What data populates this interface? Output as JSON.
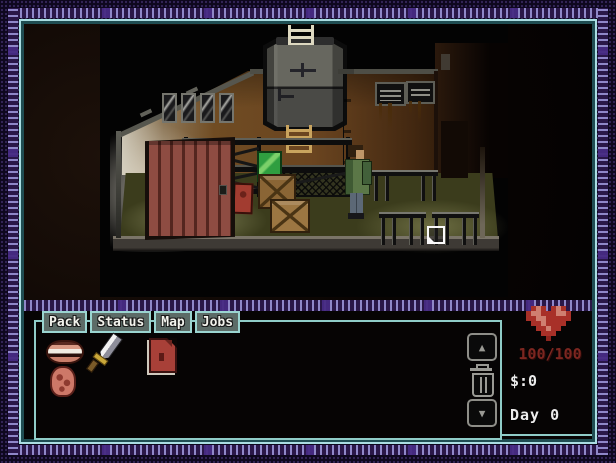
{
  "tabs": [
    {
      "label": "Pack"
    },
    {
      "label": "Status"
    },
    {
      "label": "Map"
    },
    {
      "label": "Jobs"
    }
  ],
  "inventory": {
    "items": [
      {
        "name": "dentures"
      },
      {
        "name": "machete"
      },
      {
        "name": "red-book"
      },
      {
        "name": "raw-meat"
      }
    ],
    "controls": {
      "up": "arrow-up-icon",
      "trash": "trash-icon",
      "down": "arrow-down-icon"
    },
    "up_glyph": "▲",
    "down_glyph": "▼"
  },
  "stats": {
    "health": "100/100",
    "money": "$:0",
    "day": "Day 0"
  },
  "scene": {
    "objects": [
      "water-tank",
      "roof-ladder",
      "floor-ladder",
      "barred-window",
      "wall-vents",
      "plank-door",
      "storage-rack",
      "mesh-counter",
      "green-box",
      "wooden-crates",
      "red-canister",
      "survivor-character",
      "work-benches",
      "page-cursor"
    ]
  },
  "colors": {
    "frame_dash": "#8f87c8",
    "inner_cyan": "#aadde2",
    "inner_teal": "#1f4d52",
    "panel_border": "#8fccc8",
    "tab_fill": "#5c6b67",
    "heart_red": "#a83028",
    "hp_text_red": "#7c2620",
    "ui_text": "#ececec"
  }
}
